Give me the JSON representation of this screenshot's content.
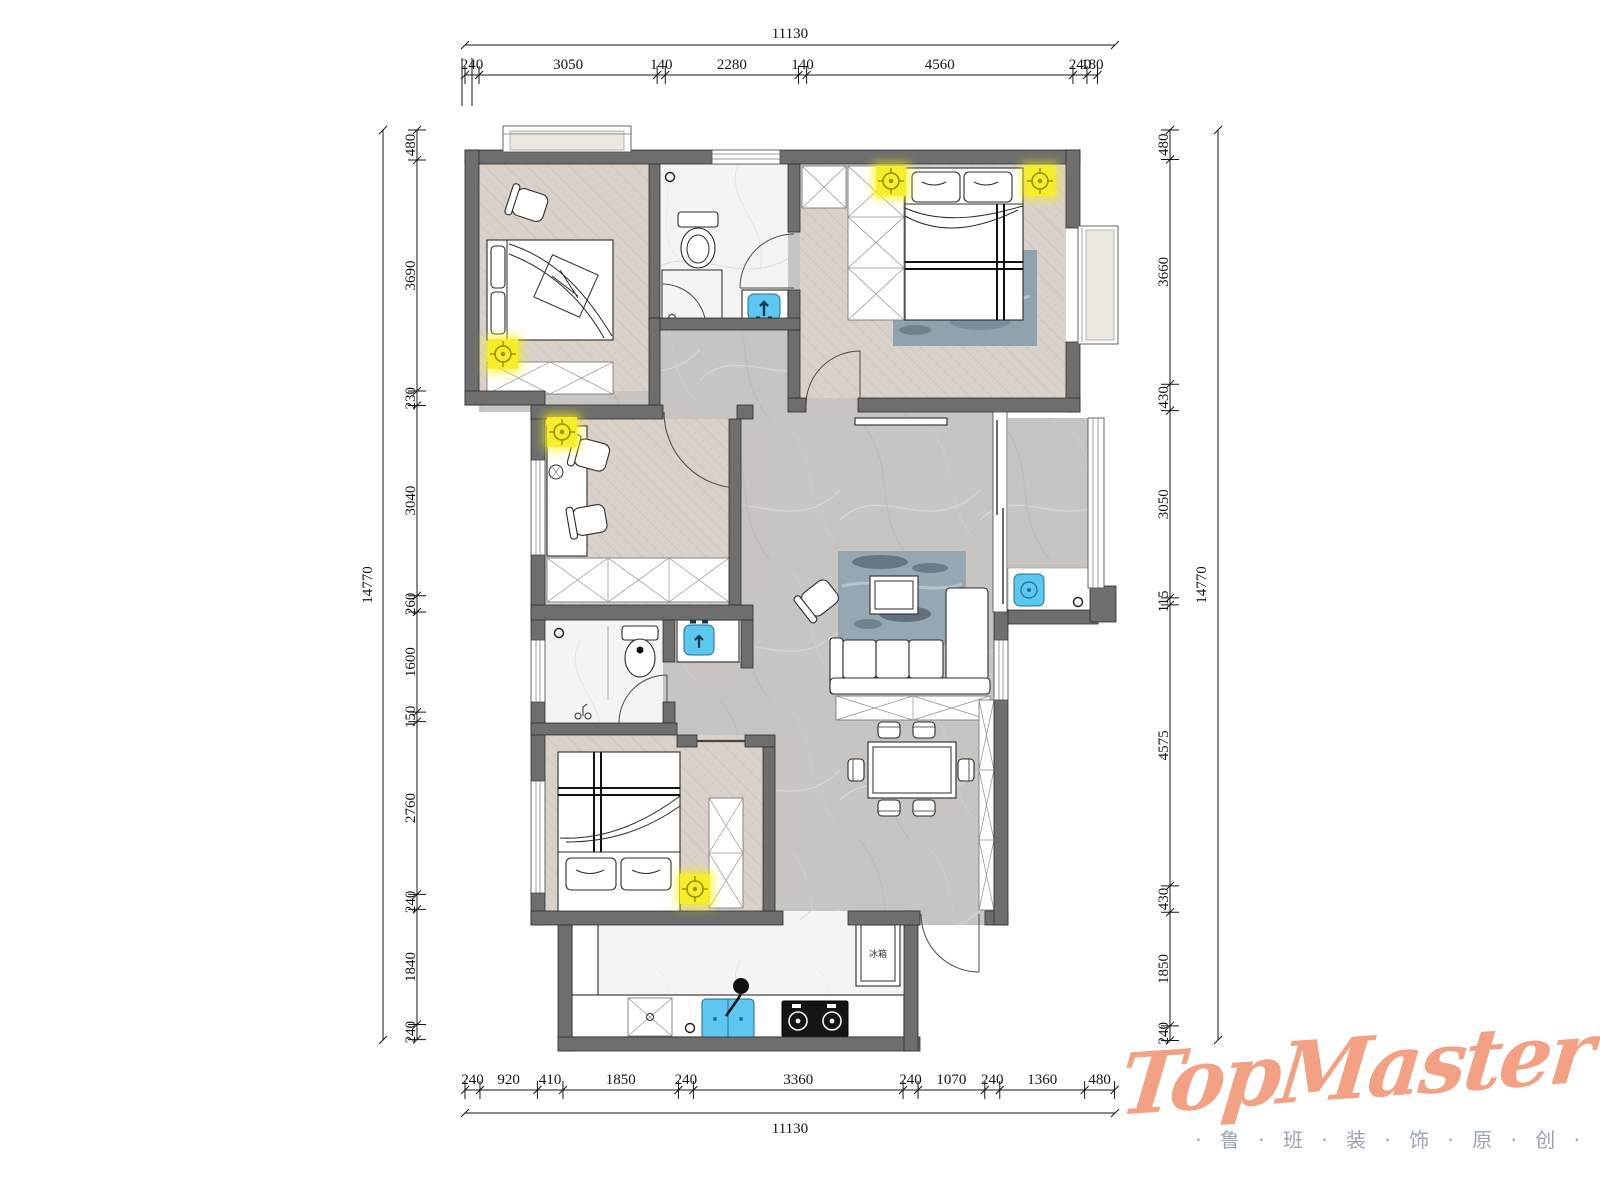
{
  "dimensions": {
    "top": {
      "total": "11130",
      "segments": [
        "240",
        "3050",
        "140",
        "2280",
        "140",
        "4560",
        "240",
        "180"
      ]
    },
    "bottom": {
      "total": "11130",
      "segments": [
        "240",
        "920",
        "410",
        "1850",
        "240",
        "3360",
        "240",
        "1070",
        "240",
        "1360",
        "480"
      ]
    },
    "left": {
      "total": "14770",
      "segments": [
        "480",
        "3690",
        "230",
        "3040",
        "260",
        "1600",
        "150",
        "2760",
        "240",
        "1840",
        "240"
      ]
    },
    "right": {
      "total": "14770",
      "segments": [
        "480",
        "3660",
        "430",
        "3050",
        "115",
        "4575",
        "430",
        "1850",
        "240"
      ]
    }
  },
  "labels": {
    "fridge": "冰箱"
  },
  "logo": {
    "name": "TopMaster",
    "tagline": "· 鲁 · 班 · 装 · 饰 · 原 · 创 ·"
  },
  "colors": {
    "wall": "#6e6e6e",
    "light_accent": "#f6ee2a",
    "fixture_blue": "#5ec7f0",
    "rug_blue": "#8ea2b0",
    "logo": "#f2a184",
    "tagline": "#9aa3b5"
  }
}
